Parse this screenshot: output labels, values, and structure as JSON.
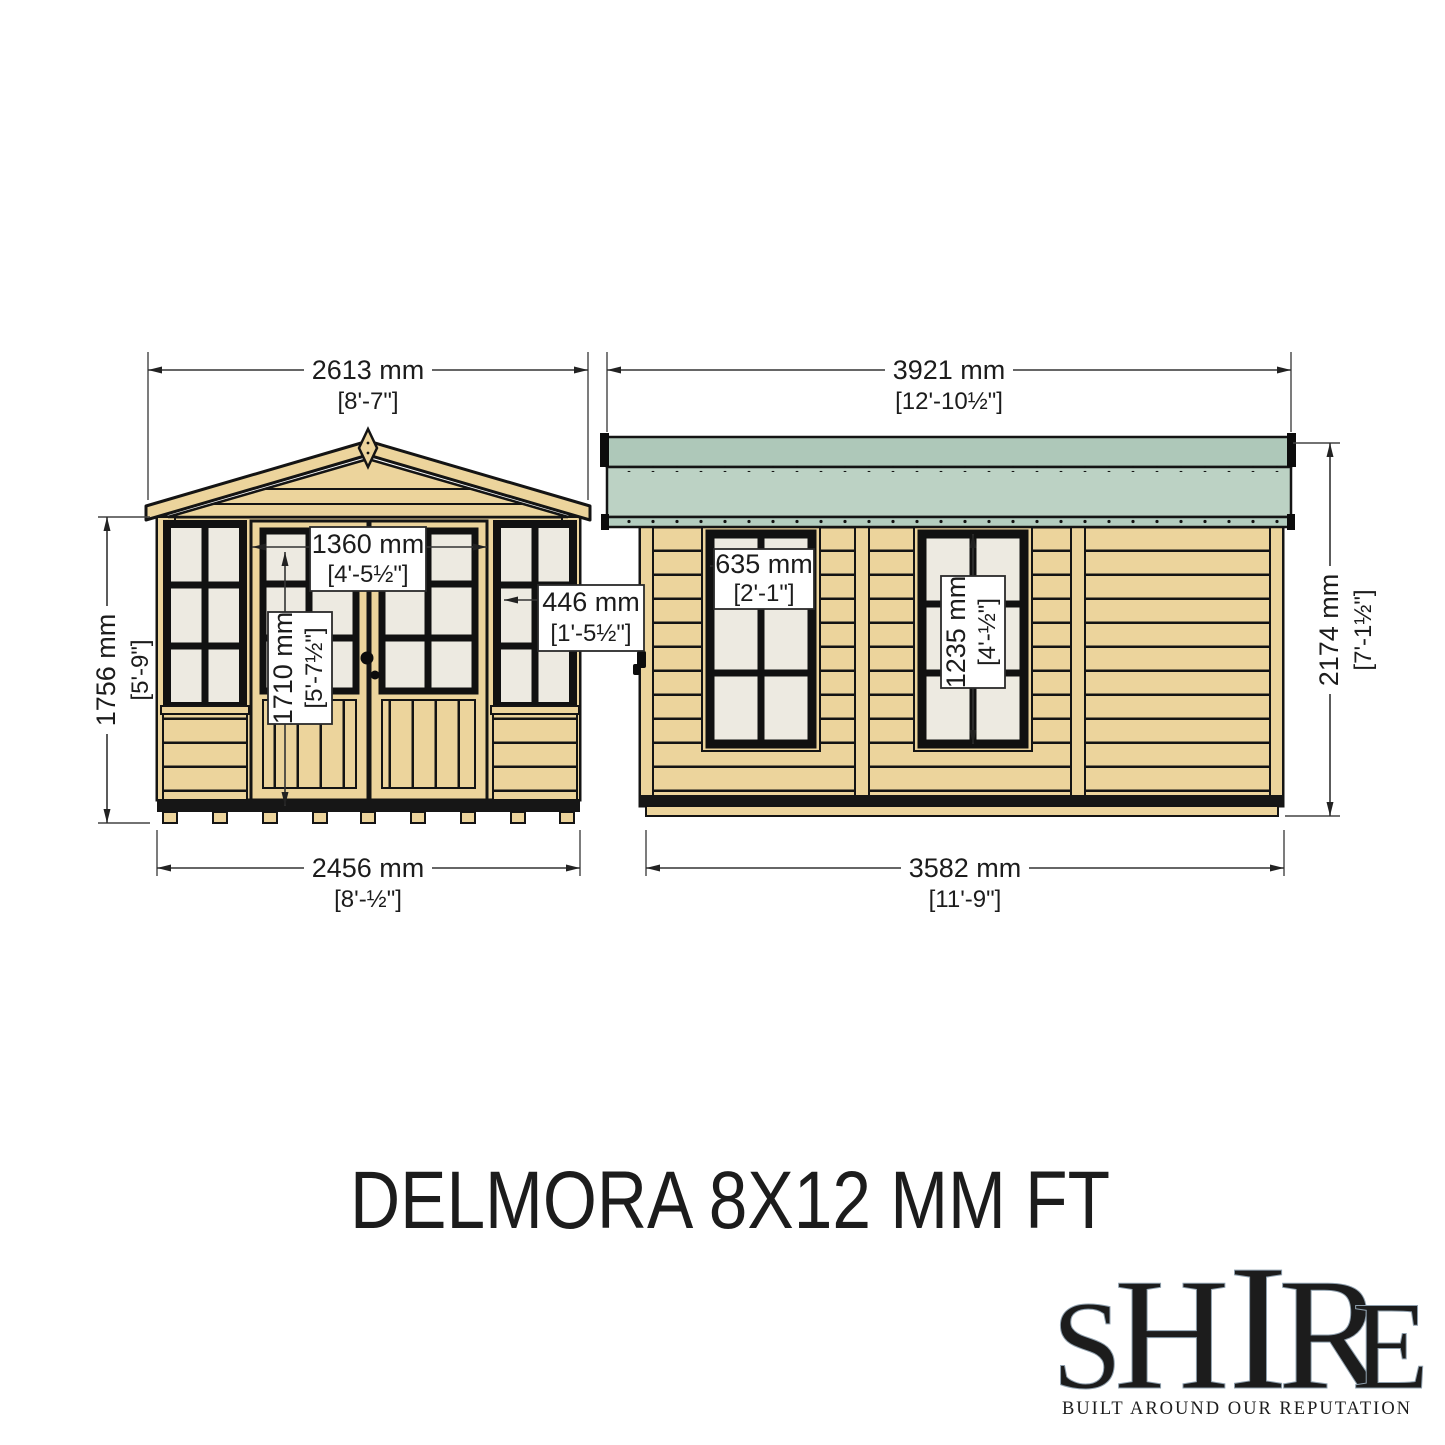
{
  "title": "DELMORA 8X12 MM FT",
  "brand": {
    "name": "SHIRE",
    "letters": [
      "S",
      "H",
      "I",
      "R",
      "E"
    ],
    "tagline": "BUILT AROUND OUR REPUTATION"
  },
  "front_view": {
    "view": "front elevation",
    "roof_width_mm": "2613 mm",
    "roof_width_ft": "[8'-7\"]",
    "height_mm": "1756 mm",
    "height_ft": "[5'-9\"]",
    "door_opening_width_mm": "1360 mm",
    "door_opening_width_ft": "[4'-5½\"]",
    "door_height_mm": "1710 mm",
    "door_height_ft": "[5'-7½\"]",
    "window_width_mm": "446 mm",
    "window_width_ft": "[1'-5½\"]",
    "base_width_mm": "2456 mm",
    "base_width_ft": "[8'-½\"]"
  },
  "side_view": {
    "view": "side elevation",
    "roof_length_mm": "3921 mm",
    "roof_length_ft": "[12'-10½\"]",
    "window_width_mm": "635 mm",
    "window_width_ft": "[2'-1\"]",
    "window_height_mm": "1235 mm",
    "window_height_ft": "[4'-½\"]",
    "wall_height_mm": "2174 mm",
    "wall_height_ft": "[7'-1½\"]",
    "base_length_mm": "3582 mm",
    "base_length_ft": "[11'-9\"]"
  },
  "colors": {
    "wood": "#ecd49c",
    "glazing": "#edeae1",
    "roof_green": "#bcd2c4",
    "roof_green_dark": "#aec8b9",
    "outline": "#141414",
    "dimension_line": "#333333",
    "logo_red": "#c8102e",
    "logo_blue": "#1b3a76",
    "logo_silver": "#dfe3e8"
  }
}
